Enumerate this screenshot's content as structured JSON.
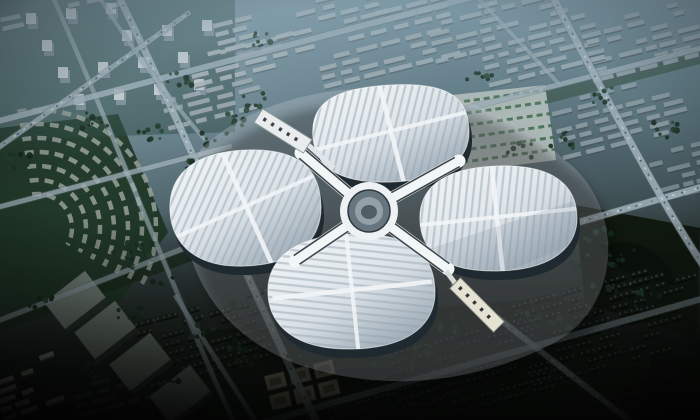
{
  "image": {
    "kind": "aerial architectural rendering (photo-like, no UI text)",
    "subject": "four-petal clover-shaped exhibition and convention center with a central circular hub and white X-shaped connector",
    "setting": "dense city blocks on diagonal avenues, parks, curved residential arcs at left, haze toward the horizon, dark vignetted foreground",
    "lighting": "cool blue dusk haze at top, deep shadow at bottom corners",
    "palette": {
      "haze_blue": "#829caa",
      "city_teal": "#4f6a70",
      "park_green": "#203827",
      "tree_green": "#23402e",
      "road_gray": "#a6b7bf",
      "road_edge": "#5a6a72",
      "roof_white": "#eef2f5",
      "roof_stripe": "#b6c2cb",
      "roof_shade": "#bfcad3",
      "facade_dark": "#1f2930",
      "hub_gray": "#67757f",
      "arm_white": "#f3f6f7",
      "arm_edge": "#2a343b",
      "slab_light": "#aeb9bd",
      "slab_dark": "#1a221d",
      "warehouse_gray": "#7f8c84",
      "beige_block": "#b2a98f",
      "foreground_dark": "#0b0e0b"
    },
    "landmarks": {
      "north_hall": "striped petal roof, upper",
      "west_hall": "striped petal roof, left",
      "east_hall": "striped petal roof, right",
      "south_hall": "striped petal roof, lower",
      "central_hub": "circular core ringed by white X connector",
      "northwest_entrance": "white entrance hall with dark skylights",
      "southeast_entrance": "white entrance hall with dark skylights",
      "east_intersection": "major road crossing east of the building",
      "arc_neighborhood": "concentric curved building rows in park, left",
      "warehouse_row": "large flat-roof boxes, lower left"
    }
  }
}
